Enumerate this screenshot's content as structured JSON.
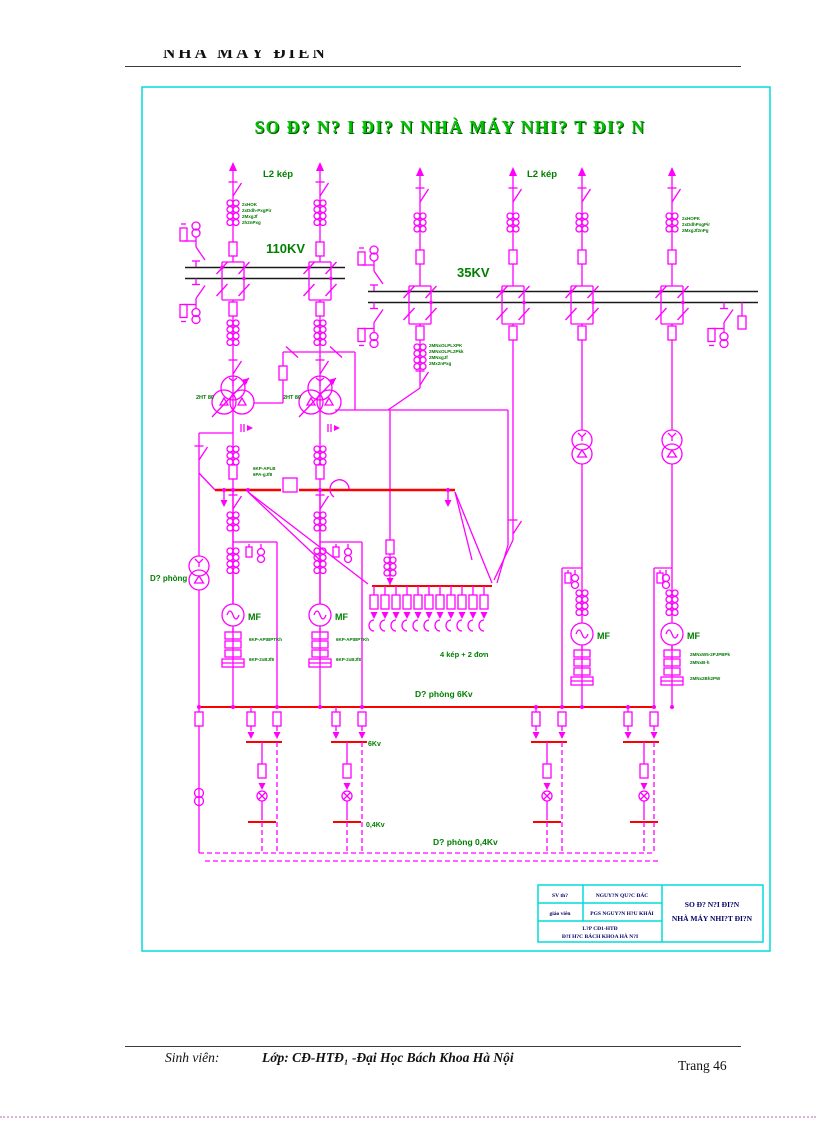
{
  "colors": {
    "magenta": "#ff00ff",
    "red": "#ff0000",
    "green": "#008000",
    "title_green": "#00c400",
    "cyan": "#00dcdc",
    "navy": "#000066"
  },
  "page": {
    "header_title": "NHÀ MÁY ĐIÊN",
    "footer_student": "Sinh viên:",
    "footer_class": "Lớp: CĐ-HTĐ₁ -Đại Học Bách Khoa Hà Nội",
    "footer_page": "Trang 46"
  },
  "diagram": {
    "title": "SO Đ?  N? I ĐI? N NHÀ MÁY NHI? T ĐI? N",
    "labels": {
      "l2kep": "L2 kép",
      "kv110": "110KV",
      "kv35": "35KV",
      "duphong": "D? phòng",
      "tr80": "2HT 80",
      "gen": "MF",
      "feeders": "4 kép + 2 đơn",
      "dp6": "D? phòng 6Kv",
      "kv6": "6Kv",
      "kv04": "0,4Kv",
      "dp04": "D? phòng 0,4Kv"
    },
    "specs": {
      "s110": [
        "2xHOK",
        "2xDdh-PxgPir",
        "2MxgJf",
        "2h2nPxg"
      ],
      "s35r": [
        "2xHOPK",
        "2xDdhPxgPir",
        "2MxgJf2nPg"
      ],
      "s35b": [
        "2MNxOLPLXPK",
        "2MNxOLPL2Pkk",
        "2MNxgJf",
        "2Mx2nPxg"
      ],
      "react": [
        "6KP-APLB",
        "6PA-gJf8"
      ],
      "gen12": [
        "6KP-APtBPTKh",
        "6KP-2xBJf8"
      ],
      "gen4": [
        "2MNxW5-2PJPBPk",
        "2MNxB-h",
        "2MNx2Bh2PW"
      ]
    },
    "titleblock": {
      "r1c1": "SV th?",
      "r1c2": "NGUY?N QU?C ĐÁC",
      "r2c1": "giáo viên",
      "r2c2": "PGS NGUY?N H?U KHÁI",
      "r3a": "L?P CĐ1-HTĐ",
      "r3b": "Đ?I H?C BÁCH KHOA HÀ N?I",
      "t1": "SO Đ? N?I ĐI?N",
      "t2": "NHÀ MÁY NHI?T ĐI?N"
    }
  }
}
